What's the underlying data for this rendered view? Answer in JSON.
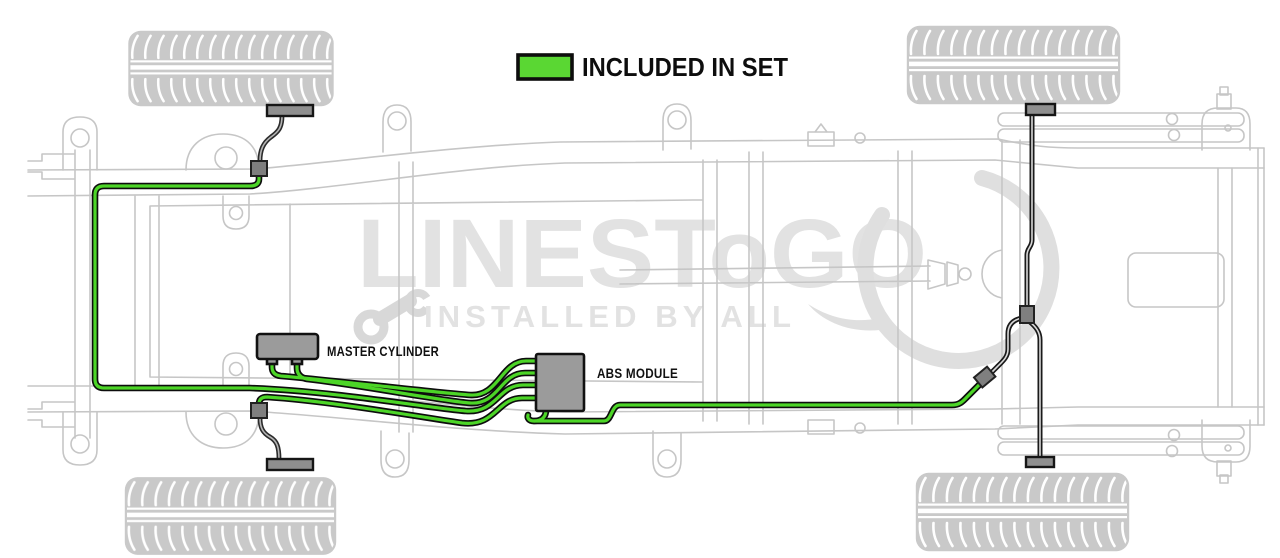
{
  "legend": {
    "label": "INCLUDED IN SET",
    "swatch_color": "#5ad733"
  },
  "components": {
    "master_cylinder_label": "MASTER CYLINDER",
    "abs_module_label": "ABS MODULE"
  },
  "watermark": {
    "brand": "LINESToGO",
    "tagline": "INSTALLED BY ALL"
  },
  "colors": {
    "included_line_green": "#4cd527",
    "excluded_line_black": "#1a1a1a",
    "component_gray": "#9b9b9b",
    "frame_outline_gray": "#c6c6c6",
    "tire_gray": "#c9c9c9",
    "watermark_gray": "#e2e2e2"
  },
  "diagram": {
    "subject": "truck chassis underside brake line routing",
    "wheels": 4,
    "included_lines_color_meaning": "INCLUDED IN SET"
  }
}
